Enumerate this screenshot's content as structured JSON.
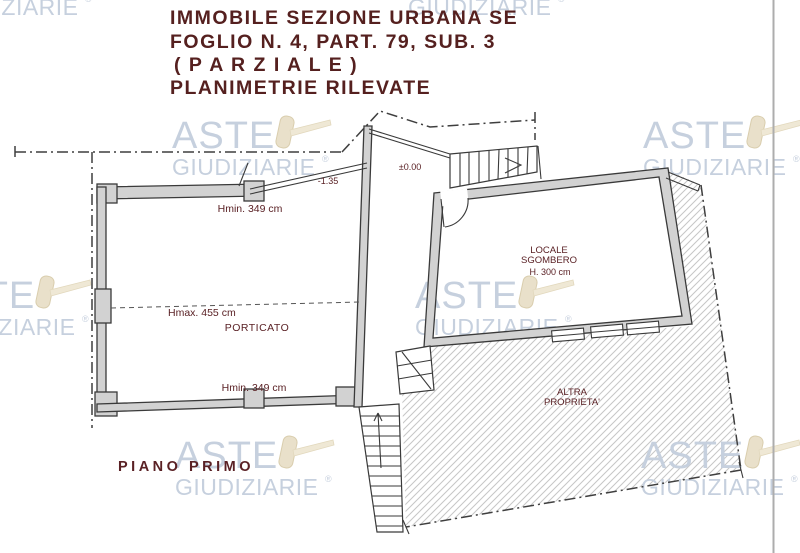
{
  "title": {
    "line1": "IMMOBILE SEZIONE URBANA SE",
    "line2": "FOGLIO N. 4, PART. 79, SUB. 3",
    "line3": "( P A R Z I A L E )",
    "line4": "PLANIMETRIE RILEVATE"
  },
  "watermark": {
    "line1": "ASTE",
    "line2": "GIUDIZIARIE",
    "registered": "®"
  },
  "plan": {
    "floor_label": "PIANO PRIMO",
    "levels": {
      "terrace": "-1.35",
      "landing": "±0.00"
    },
    "porticato": {
      "name": "PORTICATO",
      "hmin_top": "Hmin. 349 cm",
      "hmax": "Hmax. 455 cm",
      "hmin_bottom": "Hmin. 349 cm"
    },
    "locale_sgombero": {
      "name_line1": "LOCALE",
      "name_line2": "SGOMBERO",
      "height": "H. 300 cm"
    },
    "adjacent_property": {
      "line1": "ALTRA",
      "line2": "PROPRIETA'"
    }
  },
  "colors": {
    "title_maroon": "#55201f",
    "label_maroon": "#5a2125",
    "watermark_blue": "#c6d0de",
    "gavel_beige": "#e9e0ca",
    "wall_gray": "#d2d2d2",
    "line_dark": "#3a3a3a",
    "hatch_gray": "#c6c6c6",
    "page_edge_gray": "#adadad"
  }
}
